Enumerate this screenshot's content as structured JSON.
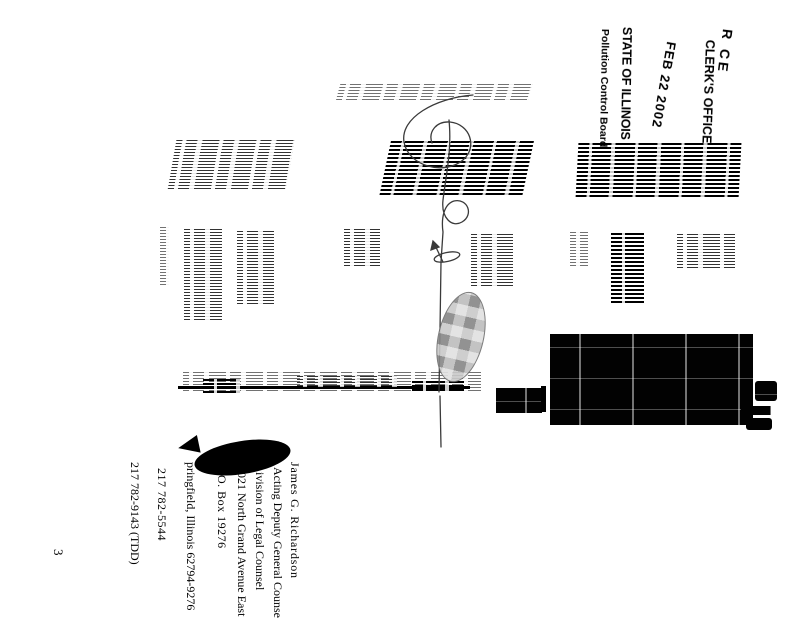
{
  "stamp": {
    "received": "R CE",
    "office": "CLERK'S OFFICE",
    "date": "FEB 22 2002",
    "state": "STATE OF ILLINOIS",
    "board": "Pollution Control Board"
  },
  "signature_block": {
    "name": "James G. Richardson",
    "title": "Acting Deputy General Counsel",
    "division": "ivision of Legal Counsel",
    "address_line1": "021 North Grand Avenue East",
    "address_line2": "O. Box 19276",
    "address_line3": "pringfield, Illinois 62794-9276",
    "phone": "217 782-5544",
    "tdd_phone": "217 782-9143 (TDD)"
  },
  "page_number": "3",
  "ink_color": "#000000"
}
